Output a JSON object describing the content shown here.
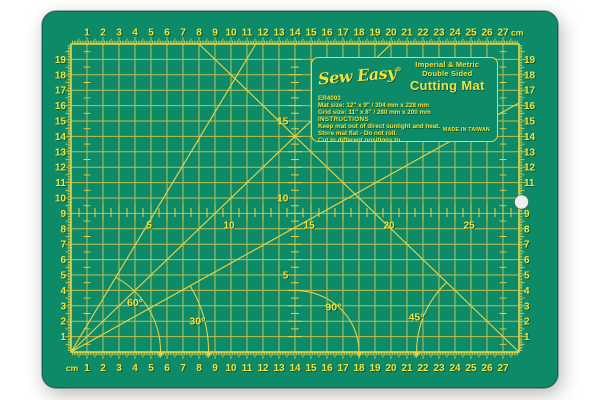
{
  "photo": {
    "background_color": "#ffffff",
    "subject": "self-healing cutting mat"
  },
  "mat": {
    "colors": {
      "surface": "#0d8a67",
      "grid_line": "#cfc14e",
      "ruler_line": "#e2d24a",
      "number_yellow": "#f4e33b",
      "shadow_green": "#00402e",
      "hole_fill": "#efefef"
    },
    "rulers": {
      "top": {
        "numbers": [
          1,
          2,
          3,
          4,
          5,
          6,
          7,
          8,
          9,
          10,
          11,
          12,
          13,
          14,
          15,
          16,
          17,
          18,
          19,
          20,
          21,
          22,
          23,
          24,
          25,
          26,
          27
        ],
        "unit": "cm"
      },
      "bottom": {
        "numbers": [
          1,
          2,
          3,
          4,
          5,
          6,
          7,
          8,
          9,
          10,
          11,
          12,
          13,
          14,
          15,
          16,
          17,
          18,
          19,
          20,
          21,
          22,
          23,
          24,
          25,
          26,
          27
        ],
        "unit": "cm"
      },
      "left": {
        "numbers": [
          1,
          2,
          3,
          4,
          5,
          6,
          7,
          8,
          9,
          10,
          11,
          12,
          13,
          14,
          15,
          16,
          17,
          18,
          19
        ]
      },
      "right": {
        "numbers": [
          1,
          2,
          3,
          4,
          5,
          6,
          7,
          8,
          9,
          10,
          11,
          12,
          13,
          14,
          15,
          16,
          17,
          18,
          19
        ],
        "hidden_number": 10
      },
      "center_horizontal": {
        "labels": [
          5,
          10,
          15,
          20,
          25
        ]
      },
      "center_vertical": {
        "labels": [
          5,
          10,
          15
        ]
      }
    },
    "diagonals": [
      {
        "from": "bottom-left",
        "angle_deg": 30
      },
      {
        "from": "bottom-left",
        "angle_deg": 45
      },
      {
        "from": "bottom-left",
        "angle_deg": 60
      },
      {
        "from": "bottom-right",
        "angle_deg": 45
      }
    ],
    "angles": [
      {
        "label": "60°",
        "vertex": "bottom-left",
        "radius_cm": 5.6
      },
      {
        "label": "30°",
        "vertex": "bottom-left",
        "radius_cm": 8.6
      },
      {
        "label": "90°",
        "vertex": "center-bottom",
        "radius_cm": 4.0
      },
      {
        "label": "45°",
        "vertex": "bottom-right",
        "radius_cm": 6.4
      }
    ],
    "label_panel": {
      "brand": "Sew Easy",
      "registered": "®",
      "tagline1": "Imperial & Metric",
      "tagline2": "Double Sided",
      "title": "Cutting Mat",
      "model": "ER4093",
      "mat_size": "Mat size: 12\" x 9\" / 304 mm x 228 mm",
      "grid_size": "Grid size: 11\" x 8\" / 280 mm x 200 mm",
      "instructions_heading": "INSTRUCTIONS",
      "instructions": [
        "Keep mat out of direct sunlight and heat.",
        "Store mat flat - Do not roll.",
        "Cut in different positions to",
        "extend the life of the mat."
      ],
      "made_in": "MADE IN TAIWAN"
    }
  }
}
